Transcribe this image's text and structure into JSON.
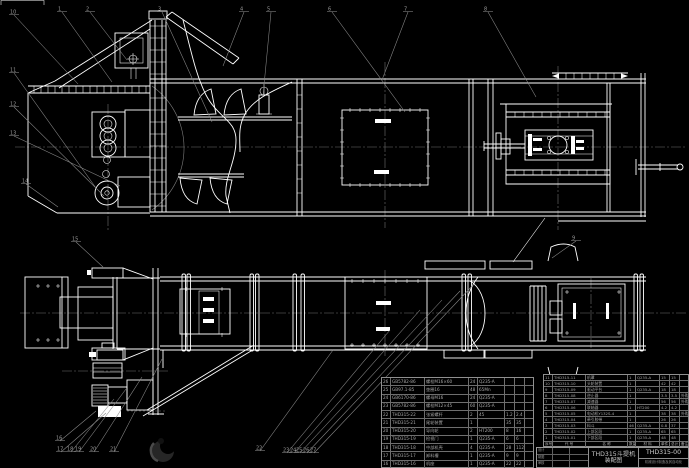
{
  "colors": {
    "background": "#000000",
    "line": "#ffffff",
    "leader": "#8a8a8a",
    "table_border": "#8f8f8f",
    "table_text": "#a6a6a6"
  },
  "title_block": {
    "product": "THD315斗提机",
    "doc_type": "装配图",
    "drawing_no": "THD315-00",
    "org": "机械设计制造及其自动化",
    "signature_rows": [
      [
        "设计",
        "",
        ""
      ],
      [
        "制图",
        "",
        ""
      ],
      [
        "审核",
        "",
        ""
      ]
    ]
  },
  "bom_header": [
    "序号",
    "代 号",
    "名 称",
    "数量",
    "材 料",
    "单件",
    "总计",
    "备注"
  ],
  "bom_left": {
    "rows": [
      [
        "26",
        "GB5782-86",
        "螺栓M16×60",
        "24",
        "Q235-A",
        "",
        "",
        ""
      ],
      [
        "25",
        "GB97.1-85",
        "垫圈16",
        "48",
        "65Mn",
        "",
        "",
        ""
      ],
      [
        "24",
        "GB6170-86",
        "螺母M16",
        "24",
        "Q235-A",
        "",
        "",
        ""
      ],
      [
        "23",
        "GB5782-86",
        "螺栓M12×45",
        "60",
        "Q235-A",
        "",
        "",
        ""
      ],
      [
        "22",
        "THD315-22",
        "张紧螺杆",
        "2",
        "45",
        "1.2",
        "2.4",
        ""
      ],
      [
        "21",
        "THD315-21",
        "尾轮装置",
        "1",
        "",
        "35",
        "35",
        ""
      ],
      [
        "20",
        "THD315-20",
        "导向轮",
        "2",
        "HT200",
        "8",
        "16",
        ""
      ],
      [
        "19",
        "THD315-19",
        "检视门",
        "1",
        "Q235-A",
        "6",
        "6",
        ""
      ],
      [
        "18",
        "THD315-18",
        "中部机壳",
        "4",
        "Q235-A",
        "28",
        "112",
        ""
      ],
      [
        "17",
        "THD315-17",
        "卸料槽",
        "1",
        "Q235-A",
        "9",
        "9",
        ""
      ],
      [
        "16",
        "THD315-16",
        "机座",
        "1",
        "Q235-A",
        "22",
        "22",
        ""
      ]
    ]
  },
  "bom_right": {
    "rows": [
      [
        "11",
        "THD315-11",
        "机罩",
        "1",
        "Q235-A",
        "15",
        "15",
        ""
      ],
      [
        "10",
        "THD315-10",
        "头轮装置",
        "1",
        "",
        "42",
        "42",
        ""
      ],
      [
        "9",
        "THD315-09",
        "驱动平台",
        "1",
        "Q235-A",
        "18",
        "18",
        ""
      ],
      [
        "8",
        "THD315-08",
        "逆止器",
        "1",
        "",
        "3.5",
        "3.5",
        "外购"
      ],
      [
        "7",
        "THD315-07",
        "减速器",
        "1",
        "",
        "56",
        "56",
        "外购"
      ],
      [
        "6",
        "THD315-06",
        "联轴器",
        "1",
        "HT200",
        "4.2",
        "4.2",
        ""
      ],
      [
        "5",
        "THD315-05",
        "电动机Y132S-4",
        "1",
        "",
        "38",
        "38",
        "外购"
      ],
      [
        "4",
        "THD315-04",
        "牵引胶带",
        "1",
        "",
        "26",
        "26",
        ""
      ],
      [
        "3",
        "THD315-03",
        "料斗",
        "46",
        "Q235-A",
        "0.8",
        "37",
        ""
      ],
      [
        "2",
        "THD315-02",
        "上部区段",
        "1",
        "Q235-A",
        "65",
        "65",
        ""
      ],
      [
        "1",
        "THD315-01",
        "下部区段",
        "1",
        "Q235-A",
        "48",
        "48",
        ""
      ]
    ]
  },
  "callouts": [
    {
      "n": "1",
      "x": 60,
      "y": 8,
      "tx": 112,
      "ty": 82
    },
    {
      "n": "2",
      "x": 88,
      "y": 8,
      "tx": 127,
      "ty": 60
    },
    {
      "n": "3",
      "x": 160,
      "y": 8,
      "tx": 212,
      "ty": 122
    },
    {
      "n": "4",
      "x": 242,
      "y": 8,
      "tx": 223,
      "ty": 66
    },
    {
      "n": "5",
      "x": 269,
      "y": 8,
      "tx": 263,
      "ty": 96
    },
    {
      "n": "6",
      "x": 330,
      "y": 8,
      "tx": 405,
      "ty": 112
    },
    {
      "n": "7",
      "x": 406,
      "y": 8,
      "tx": 382,
      "ty": 80
    },
    {
      "n": "8",
      "x": 486,
      "y": 8,
      "tx": 536,
      "ty": 97
    },
    {
      "n": "9",
      "x": 574,
      "y": 237,
      "tx": 552,
      "ty": 258
    },
    {
      "n": "10",
      "x": 12,
      "y": 11,
      "tx": 78,
      "ty": 84
    },
    {
      "n": "11",
      "x": 12,
      "y": 69,
      "tx": 96,
      "ty": 188
    },
    {
      "n": "12",
      "x": 12,
      "y": 103,
      "tx": 104,
      "ty": 196
    },
    {
      "n": "13",
      "x": 12,
      "y": 132,
      "tx": 120,
      "ty": 186
    },
    {
      "n": "14",
      "x": 24,
      "y": 180,
      "tx": 58,
      "ty": 207
    },
    {
      "n": "15",
      "x": 74,
      "y": 238,
      "tx": 103,
      "ty": 267
    },
    {
      "n": "16",
      "x": 58,
      "y": 437,
      "tx": 96,
      "ty": 411
    },
    {
      "n": "17",
      "x": 59,
      "y": 448,
      "tx": 106,
      "ty": 413
    },
    {
      "n": "18",
      "x": 69,
      "y": 448,
      "tx": 114,
      "ty": 399
    },
    {
      "n": "19",
      "x": 77,
      "y": 448,
      "tx": 126,
      "ty": 389
    },
    {
      "n": "20",
      "x": 92,
      "y": 448,
      "tx": 142,
      "ty": 377
    },
    {
      "n": "21",
      "x": 112,
      "y": 448,
      "tx": 162,
      "ty": 359
    },
    {
      "n": "22",
      "x": 258,
      "y": 447,
      "tx": 333,
      "ty": 350
    },
    {
      "n": "23",
      "x": 285,
      "y": 449,
      "tx": 390,
      "ty": 330
    },
    {
      "n": "24",
      "x": 292,
      "y": 449,
      "tx": 420,
      "ty": 310
    },
    {
      "n": "25",
      "x": 298,
      "y": 449,
      "tx": 442,
      "ty": 300
    },
    {
      "n": "26",
      "x": 305,
      "y": 449,
      "tx": 460,
      "ty": 291
    },
    {
      "n": "27",
      "x": 312,
      "y": 449,
      "tx": 475,
      "ty": 283
    }
  ]
}
